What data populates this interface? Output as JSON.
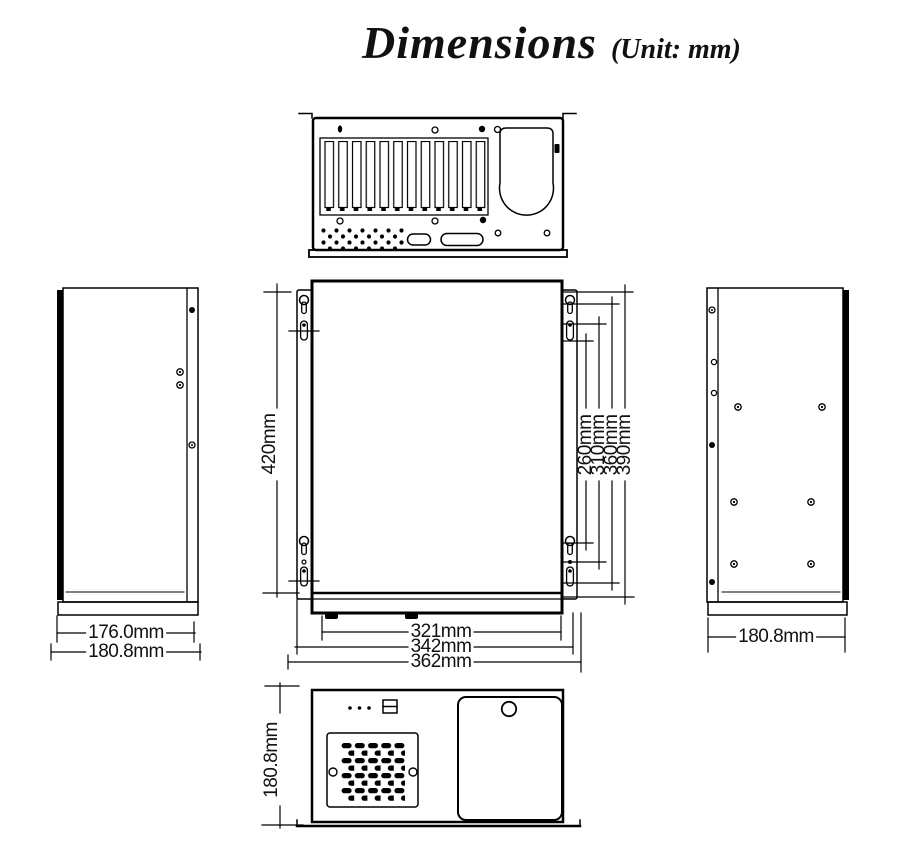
{
  "title": {
    "text": "Dimensions",
    "unit": "(Unit: mm)"
  },
  "labels": {
    "front_height": "420mm",
    "mount_spacing": [
      "260mm",
      "310mm",
      "360mm",
      "390mm"
    ],
    "widths": [
      "321mm",
      "342mm",
      "362mm"
    ],
    "left_view_depths": [
      "176.0mm",
      "180.8mm"
    ],
    "right_view_depth": "180.8mm",
    "front_view_height": "180.8mm"
  },
  "colors": {
    "line": "#000000",
    "background": "#ffffff",
    "text": "#111111"
  }
}
